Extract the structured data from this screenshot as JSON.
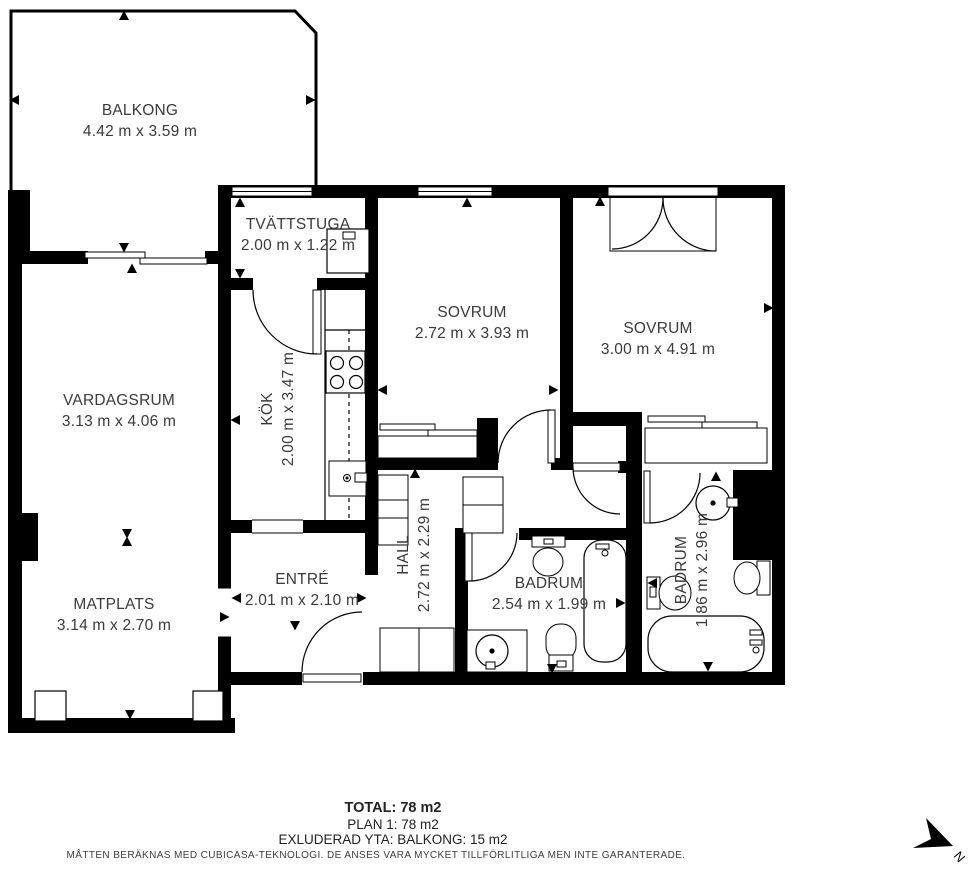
{
  "title": "Floor plan - Plan 1",
  "colors": {
    "wall": "#000000",
    "background": "#ffffff",
    "text": "#3a3a3a"
  },
  "rooms": [
    {
      "id": "balkong",
      "name": "BALKONG",
      "dims": "4.42 m x 3.59 m"
    },
    {
      "id": "tvattstuga",
      "name": "TVÄTTSTUGA",
      "dims": "2.00 m x 1.22 m"
    },
    {
      "id": "sovrum-1",
      "name": "SOVRUM",
      "dims": "2.72 m x 3.93 m"
    },
    {
      "id": "sovrum-2",
      "name": "SOVRUM",
      "dims": "3.00 m x 4.91 m"
    },
    {
      "id": "vardagsrum",
      "name": "VARDAGSRUM",
      "dims": "3.13 m x 4.06 m"
    },
    {
      "id": "kok",
      "name": "KÖK",
      "dims": "2.00 m x 3.47 m"
    },
    {
      "id": "matplats",
      "name": "MATPLATS",
      "dims": "3.14 m x 2.70 m"
    },
    {
      "id": "entre",
      "name": "ENTRÉ",
      "dims": "2.01 m x 2.10 m"
    },
    {
      "id": "hall",
      "name": "HALL",
      "dims": "2.72 m x 2.29 m"
    },
    {
      "id": "badrum-1",
      "name": "BADRUM",
      "dims": "2.54 m x 1.99 m"
    },
    {
      "id": "badrum-2",
      "name": "BADRUM",
      "dims": "1.86 m x 2.96 m"
    }
  ],
  "summary": {
    "total": "TOTAL: 78 m2",
    "plan": "PLAN 1: 78 m2",
    "excluded": "EXLUDERAD YTA: BALKONG: 15 m2"
  },
  "disclaimer": "MÅTTEN BERÄKNAS MED CUBICASA-TEKNOLOGI. DE ANSES VARA MYCKET TILLFÖRLITLIGA MEN INTE GARANTERADE.",
  "compass": {
    "label": "N"
  }
}
